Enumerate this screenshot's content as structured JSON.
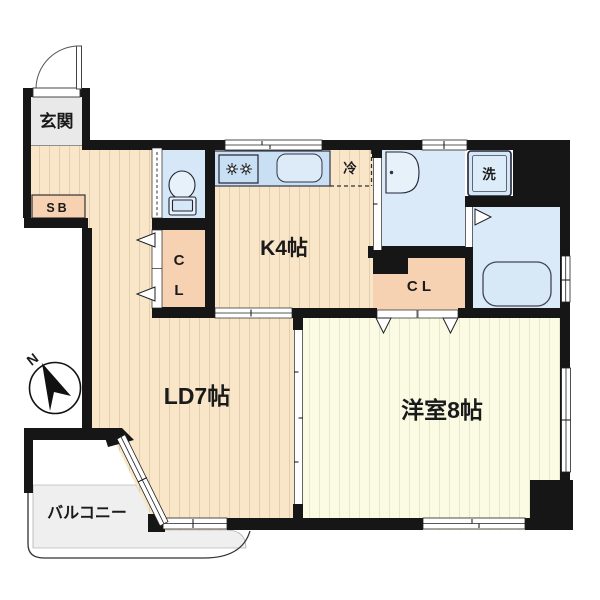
{
  "plan": {
    "type": "apartment-floor-plan",
    "rooms": {
      "genkan": {
        "label": "玄関"
      },
      "shoe_box": {
        "label": "SB"
      },
      "kitchen": {
        "label": "K4帖"
      },
      "living_dining": {
        "label": "LD7帖"
      },
      "western_room": {
        "label": "洋室8帖"
      },
      "balcony": {
        "label": "バルコニー"
      },
      "closet_hall": {
        "lines": [
          "C",
          "L"
        ]
      },
      "closet_bedroom": {
        "label": "C L"
      },
      "refrigerator_space": {
        "label": "冷"
      },
      "washer_space": {
        "label": "洗"
      }
    },
    "compass": {
      "label": "N",
      "direction": "north-upper-left"
    },
    "colors": {
      "wall": "#161616",
      "floor_peach": "#f9e6c9",
      "floor_peach_stripe": "#e3cfae",
      "floor_yellow": "#fbfbe3",
      "floor_yellow_stripe": "#e7e7cf",
      "room_blue": "#daeaf8",
      "counter_blue": "#c9e0f4",
      "fixture_blue": "#ddebf8",
      "closet_peach": "#f6d2b2",
      "balcony_gray": "#efefef",
      "genkan_gray": "#e9e9e9"
    }
  }
}
